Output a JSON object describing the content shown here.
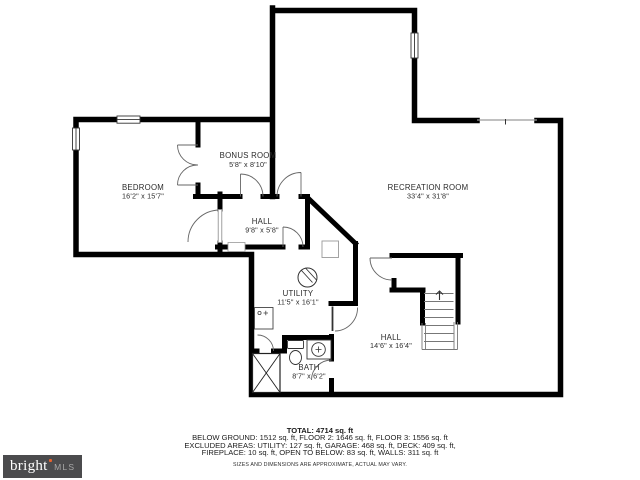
{
  "plan": {
    "wall_color": "#000000",
    "label_color": "#2b2b2b",
    "rooms": [
      {
        "name": "BEDROOM",
        "dims": "16'2\" x 15'7\""
      },
      {
        "name": "BONUS ROOM",
        "dims": "5'8\" x 8'10\""
      },
      {
        "name": "HALL",
        "dims": "9'8\" x 5'8\""
      },
      {
        "name": "RECREATION ROOM",
        "dims": "33'4\" x 31'8\""
      },
      {
        "name": "UTILITY",
        "dims": "11'5\" x 16'1\""
      },
      {
        "name": "HALL",
        "dims": "14'6\" x 16'4\""
      },
      {
        "name": "BATH",
        "dims": "8'7\" x 6'2\""
      }
    ]
  },
  "footer": {
    "total": "TOTAL: 4714 sq. ft",
    "line1": "BELOW GROUND: 1512 sq. ft, FLOOR 2: 1646 sq. ft, FLOOR 3: 1556 sq. ft",
    "line2": "EXCLUDED AREAS: UTILITY: 127 sq. ft, GARAGE: 468 sq. ft, DECK: 409 sq. ft,",
    "line3": "FIREPLACE: 10 sq. ft, OPEN TO BELOW: 83 sq. ft, WALLS: 311 sq. ft",
    "disclaimer": "SIZES AND DIMENSIONS ARE APPROXIMATE, ACTUAL MAY VARY."
  },
  "logo": {
    "brand": "bright",
    "suffix": "MLS",
    "background": "#4b4b4d",
    "accent": "#e8622d",
    "brand_color": "#ffffff",
    "suffix_color": "#a8a8a8"
  }
}
